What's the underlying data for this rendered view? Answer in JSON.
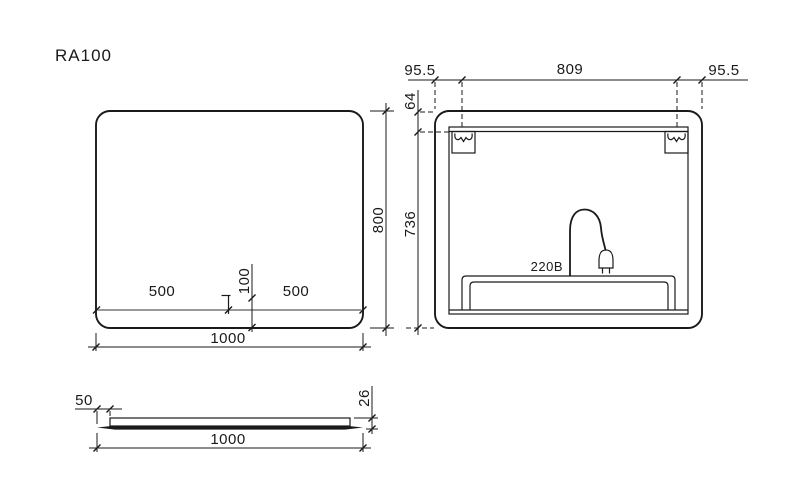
{
  "page": {
    "title": "RA100",
    "background": "#ffffff",
    "line_color": "#1a1a1a",
    "led_strip_color": "#999999"
  },
  "front_view": {
    "dim_width_total": "1000",
    "dim_height_total": "800",
    "dim_sensor_from_left": "500",
    "dim_sensor_from_right": "500",
    "dim_sensor_from_bottom": "100"
  },
  "back_view": {
    "dim_bracket_margin_left": "95.5",
    "dim_bracket_span": "809",
    "dim_bracket_margin_right": "95.5",
    "dim_bracket_from_top": "64",
    "dim_bracket_to_bottom": "736",
    "power_label": "220B"
  },
  "side_view": {
    "dim_panel_inset": "50",
    "dim_width_total": "1000",
    "dim_thickness": "26"
  }
}
